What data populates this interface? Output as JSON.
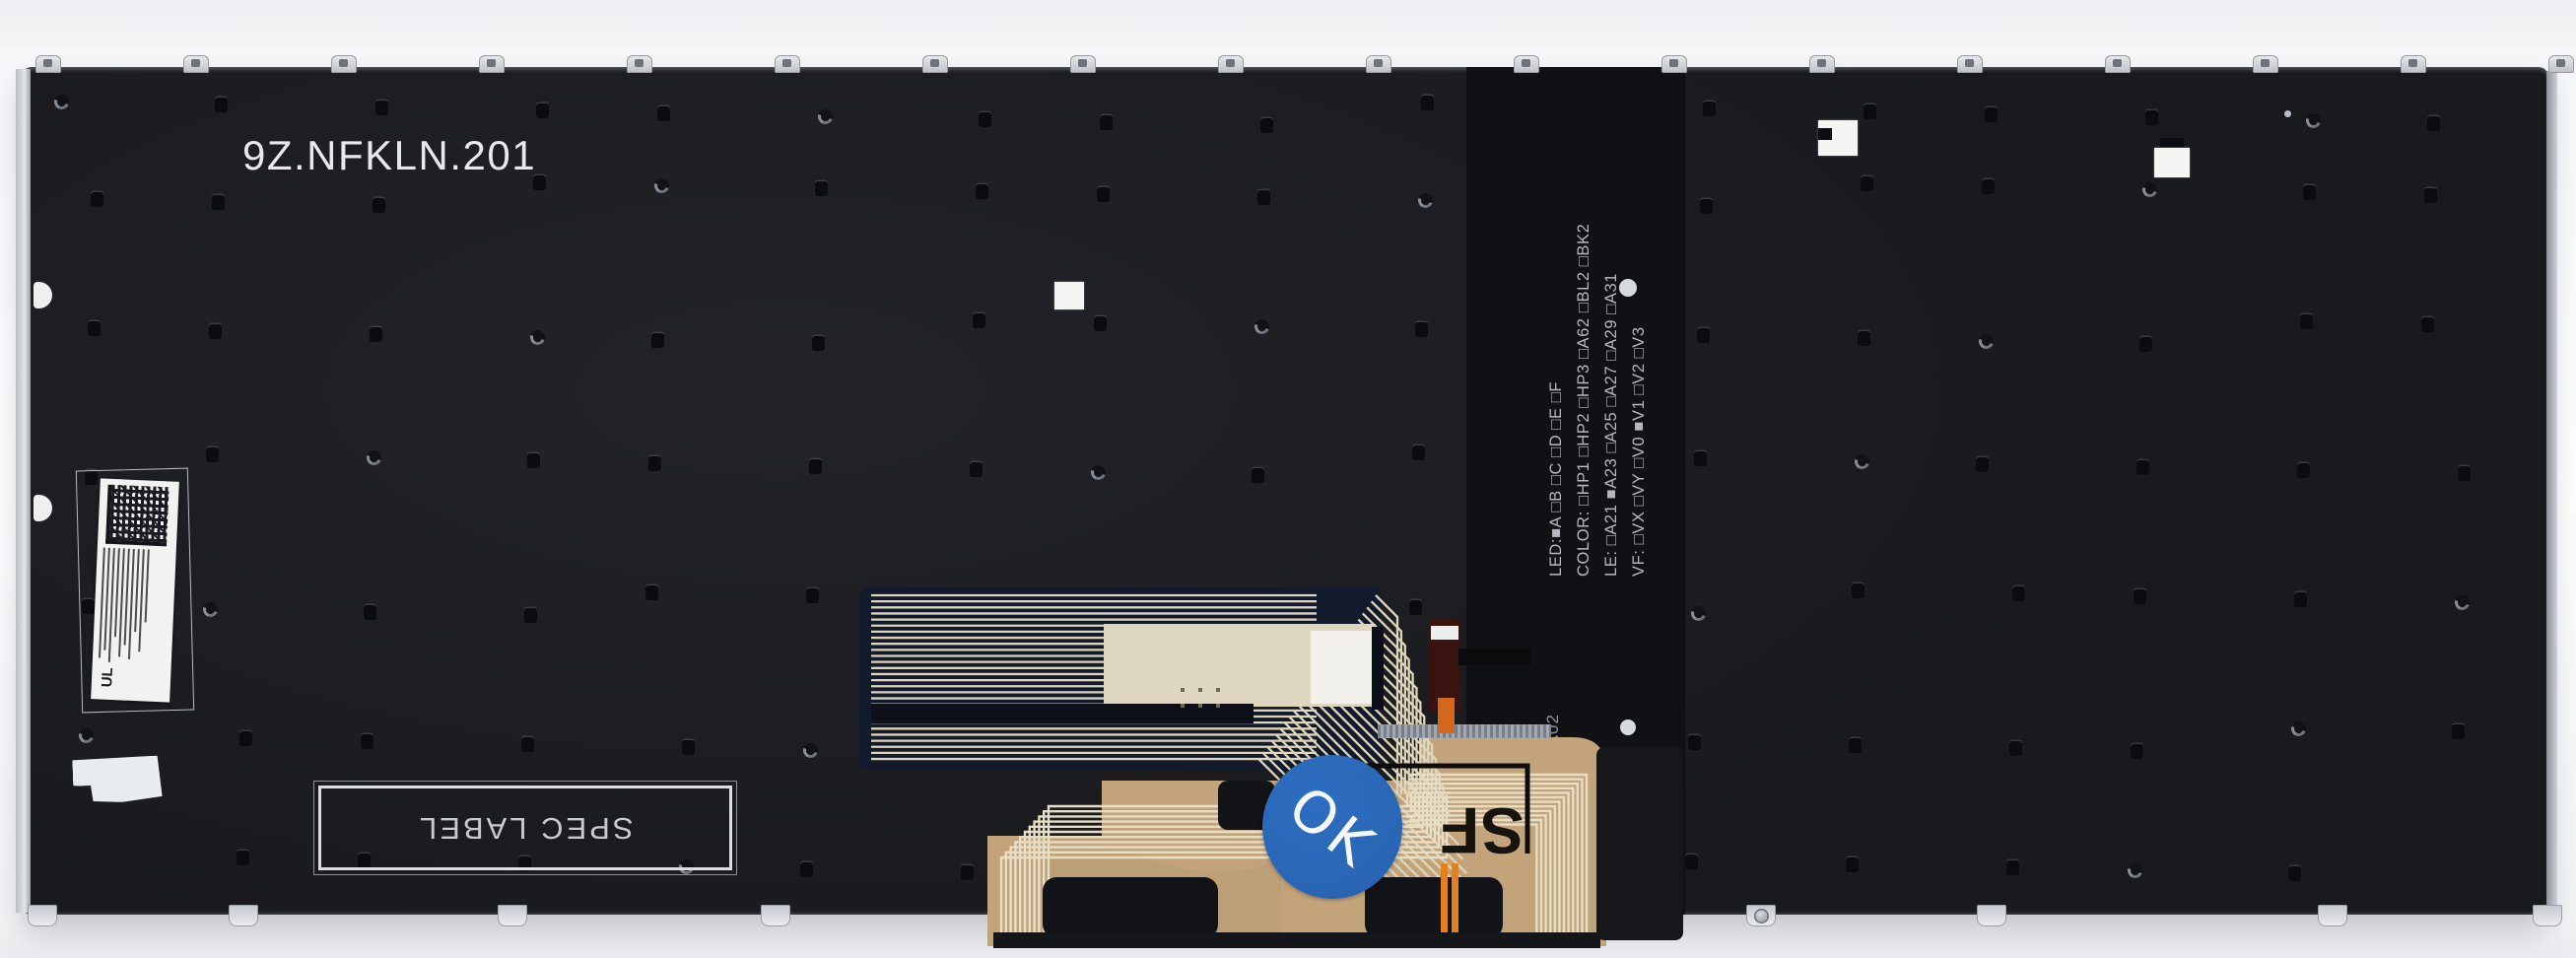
{
  "part_number": "9Z.NFKLN.201",
  "spec_label": {
    "text": "SPEC LABEL"
  },
  "backlight_spec": {
    "lines": [
      "LED:■A □B □C  □D  □E  □F",
      "COLOR: □HP1 □HP2 □HP3 □A62 □BL2 □BK2",
      "LE: □A21 ■A23 □A25 □A27 □A29  □A31",
      "VF: □VX □VY □V0 ■V1 □V2 □V3"
    ]
  },
  "flex_cable": {
    "ok_sticker_text": "OK",
    "sf_marking": "SF",
    "revision_marking": "-A02",
    "side_markings": [
      "DDB-4",
      "94VTM-0W",
      "I9085"
    ]
  },
  "barcode_label": {
    "ul_mark": "UL"
  },
  "colors": {
    "plate": "#1e1f23",
    "backlight_band": "#101114",
    "flex_tan": "#c3a47a",
    "trace_cream": "#ddd5bc",
    "ok_sticker_blue": "#2d6dc0",
    "orange_trace": "#e5811d"
  }
}
